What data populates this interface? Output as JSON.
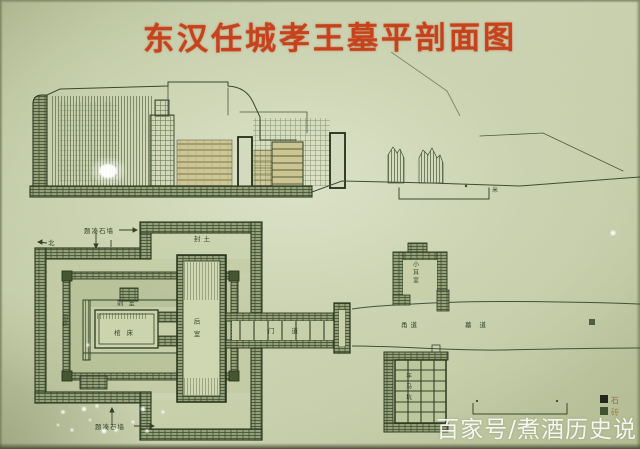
{
  "photo": {
    "board_color": "#c9d1b0",
    "ink_color": "#33402a",
    "title_color": "#c5421c"
  },
  "title": {
    "text": "东汉任城孝王墓平剖面图"
  },
  "watermark": {
    "text": "百家号/煮酒历史说"
  },
  "legend": {
    "items": [
      {
        "label": "石",
        "swatch": "#23271b"
      },
      {
        "label": "砖",
        "swatch": "#3f5132"
      }
    ]
  },
  "section": {
    "scale_unit": "米"
  },
  "plan": {
    "labels": {
      "outer_wall_top": "题凑石墙",
      "outer_wall_bottom": "题凑石墙",
      "north": "北",
      "mound": "封土",
      "gallery": "回廊",
      "front_chamber": "前室",
      "coffin_platform": "棺床",
      "rear_chamber": "后室",
      "door_passage": "门道",
      "ear_chamber": "小耳室",
      "passage_inner": "甬道",
      "passage": "墓道",
      "pit": "车马坑"
    }
  }
}
